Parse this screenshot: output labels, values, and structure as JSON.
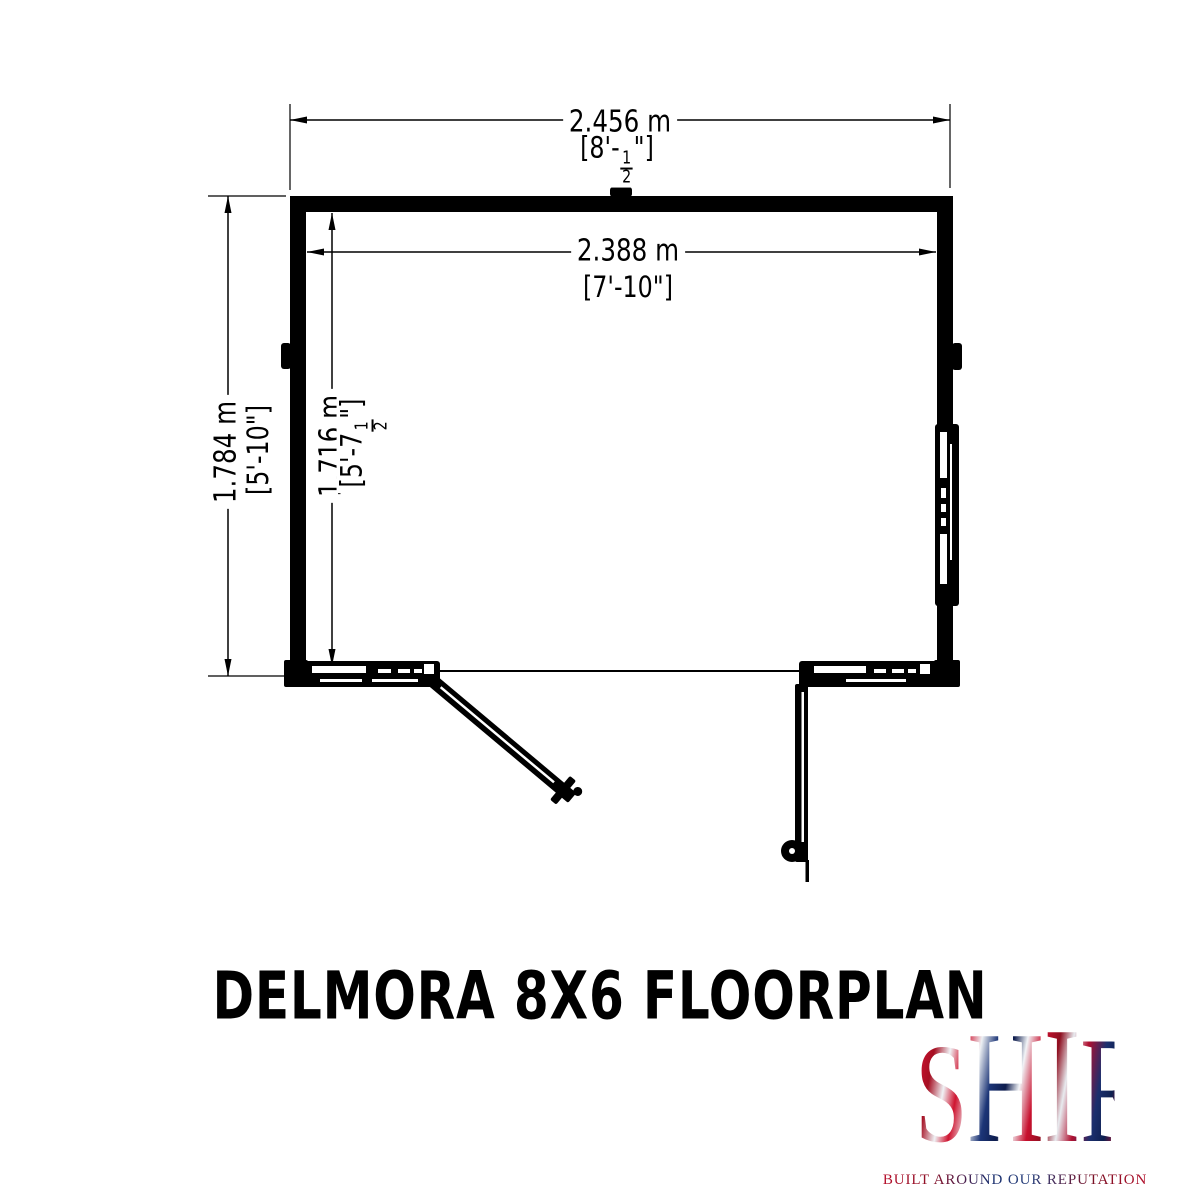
{
  "page": {
    "background": "#ffffff",
    "ink": "#000000"
  },
  "floorplan": {
    "title": "DELMORA 8X6 FLOORPLAN",
    "dimensions": {
      "outer_width": {
        "metric": "2.456 m",
        "imperial_feet": "[8'-",
        "fraction_numerator": "1",
        "fraction_denominator": "2",
        "imperial_close": "\"]"
      },
      "inner_width": {
        "metric": "2.388 m",
        "imperial": "[7'-10\"]"
      },
      "outer_depth": {
        "metric": "1.784 m",
        "imperial": "[5'-10\"]"
      },
      "inner_depth": {
        "metric": "1.716 m",
        "imperial_feet": "[5'-7",
        "fraction_numerator": "1",
        "fraction_denominator": "2",
        "imperial_close": "\"]"
      }
    }
  },
  "logo": {
    "letters": [
      "S",
      "H",
      "I",
      "R",
      "E"
    ],
    "tagline": "BUILT AROUND OUR REPUTATION",
    "colors": {
      "red": "#c8102e",
      "blue": "#1b2f6e",
      "silver": "#e8ecf1"
    }
  }
}
